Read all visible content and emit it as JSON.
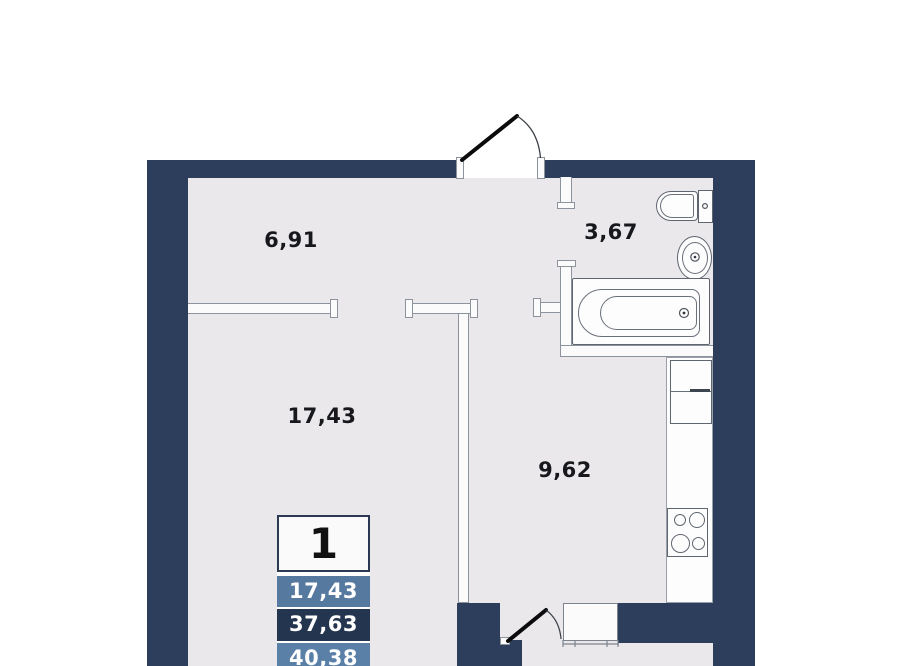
{
  "plan": {
    "title": "apartment-floor-plan",
    "rooms": [
      {
        "id": "hallway",
        "label": "6,91"
      },
      {
        "id": "bathroom",
        "label": "3,67"
      },
      {
        "id": "living-room",
        "label": "17,43"
      },
      {
        "id": "kitchen",
        "label": "9,62"
      }
    ],
    "badge": {
      "rooms_count": "1",
      "rows": [
        {
          "name": "living-area",
          "value": "17,43",
          "color": "#56799f"
        },
        {
          "name": "usable-area",
          "value": "37,63",
          "color": "#24364f"
        },
        {
          "name": "total-area",
          "value": "40,38",
          "color": "#5a80a8"
        }
      ]
    },
    "fixtures": [
      "entrance-door",
      "balcony-door",
      "balcony-window",
      "toilet",
      "sink",
      "bathtub",
      "kitchen-counter",
      "fridge",
      "stove"
    ],
    "colors": {
      "wall": "#2d3e5c",
      "floor": "#eae8eb",
      "badge_steel_blue": "#56799f",
      "badge_dark_navy": "#24364f",
      "label_text": "#17181c",
      "door_leaf": "#0b0b0b"
    }
  }
}
